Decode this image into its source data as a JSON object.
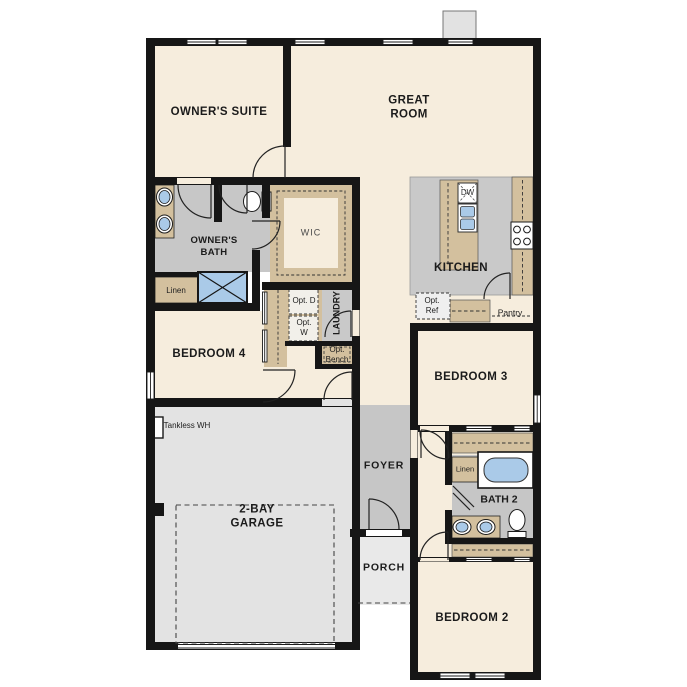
{
  "title": "Single-story house floor plan",
  "labels": {
    "owners_suite": "OWNER'S SUITE",
    "great_room": "GREAT ROOM",
    "owners_bath": "OWNER'S BATH",
    "wic": "WIC",
    "linen_1": "Linen",
    "kitchen": "KITCHEN",
    "laundry": "LAUNDRY",
    "opt_d": "Opt. D",
    "opt_w": "Opt. W",
    "opt_bench": "Opt. Bench",
    "opt_ref": "Opt. Ref",
    "pantry": "Pantry",
    "dw": "DW",
    "bedroom_4": "BEDROOM 4",
    "bedroom_3": "BEDROOM 3",
    "tankless_wh": "Tankless WH",
    "garage": "2-BAY GARAGE",
    "foyer": "FOYER",
    "porch": "PORCH",
    "linen_2": "Linen",
    "bath_2": "BATH 2",
    "bedroom_2": "BEDROOM 2"
  },
  "colors": {
    "floor_cream": "#F6EDDD",
    "wet_room_gray": "#C7C7C7",
    "garage_gray": "#E3E3E3",
    "porch_gray": "#E9E9E9",
    "cabinet_tan": "#D3C09E",
    "fixture_blue": "#AACAE8",
    "wall_black": "#161616",
    "fireplace_gray": "#E2E2E2"
  },
  "fixtures": [
    "double-sink-vanity-owners-bath",
    "toilet-owners-bath",
    "shower-owners-bath",
    "kitchen-island-sink",
    "dishwasher",
    "range-cooktop",
    "bathtub-bath2",
    "double-sink-vanity-bath2",
    "toilet-bath2",
    "tankless-water-heater",
    "fireplace"
  ]
}
